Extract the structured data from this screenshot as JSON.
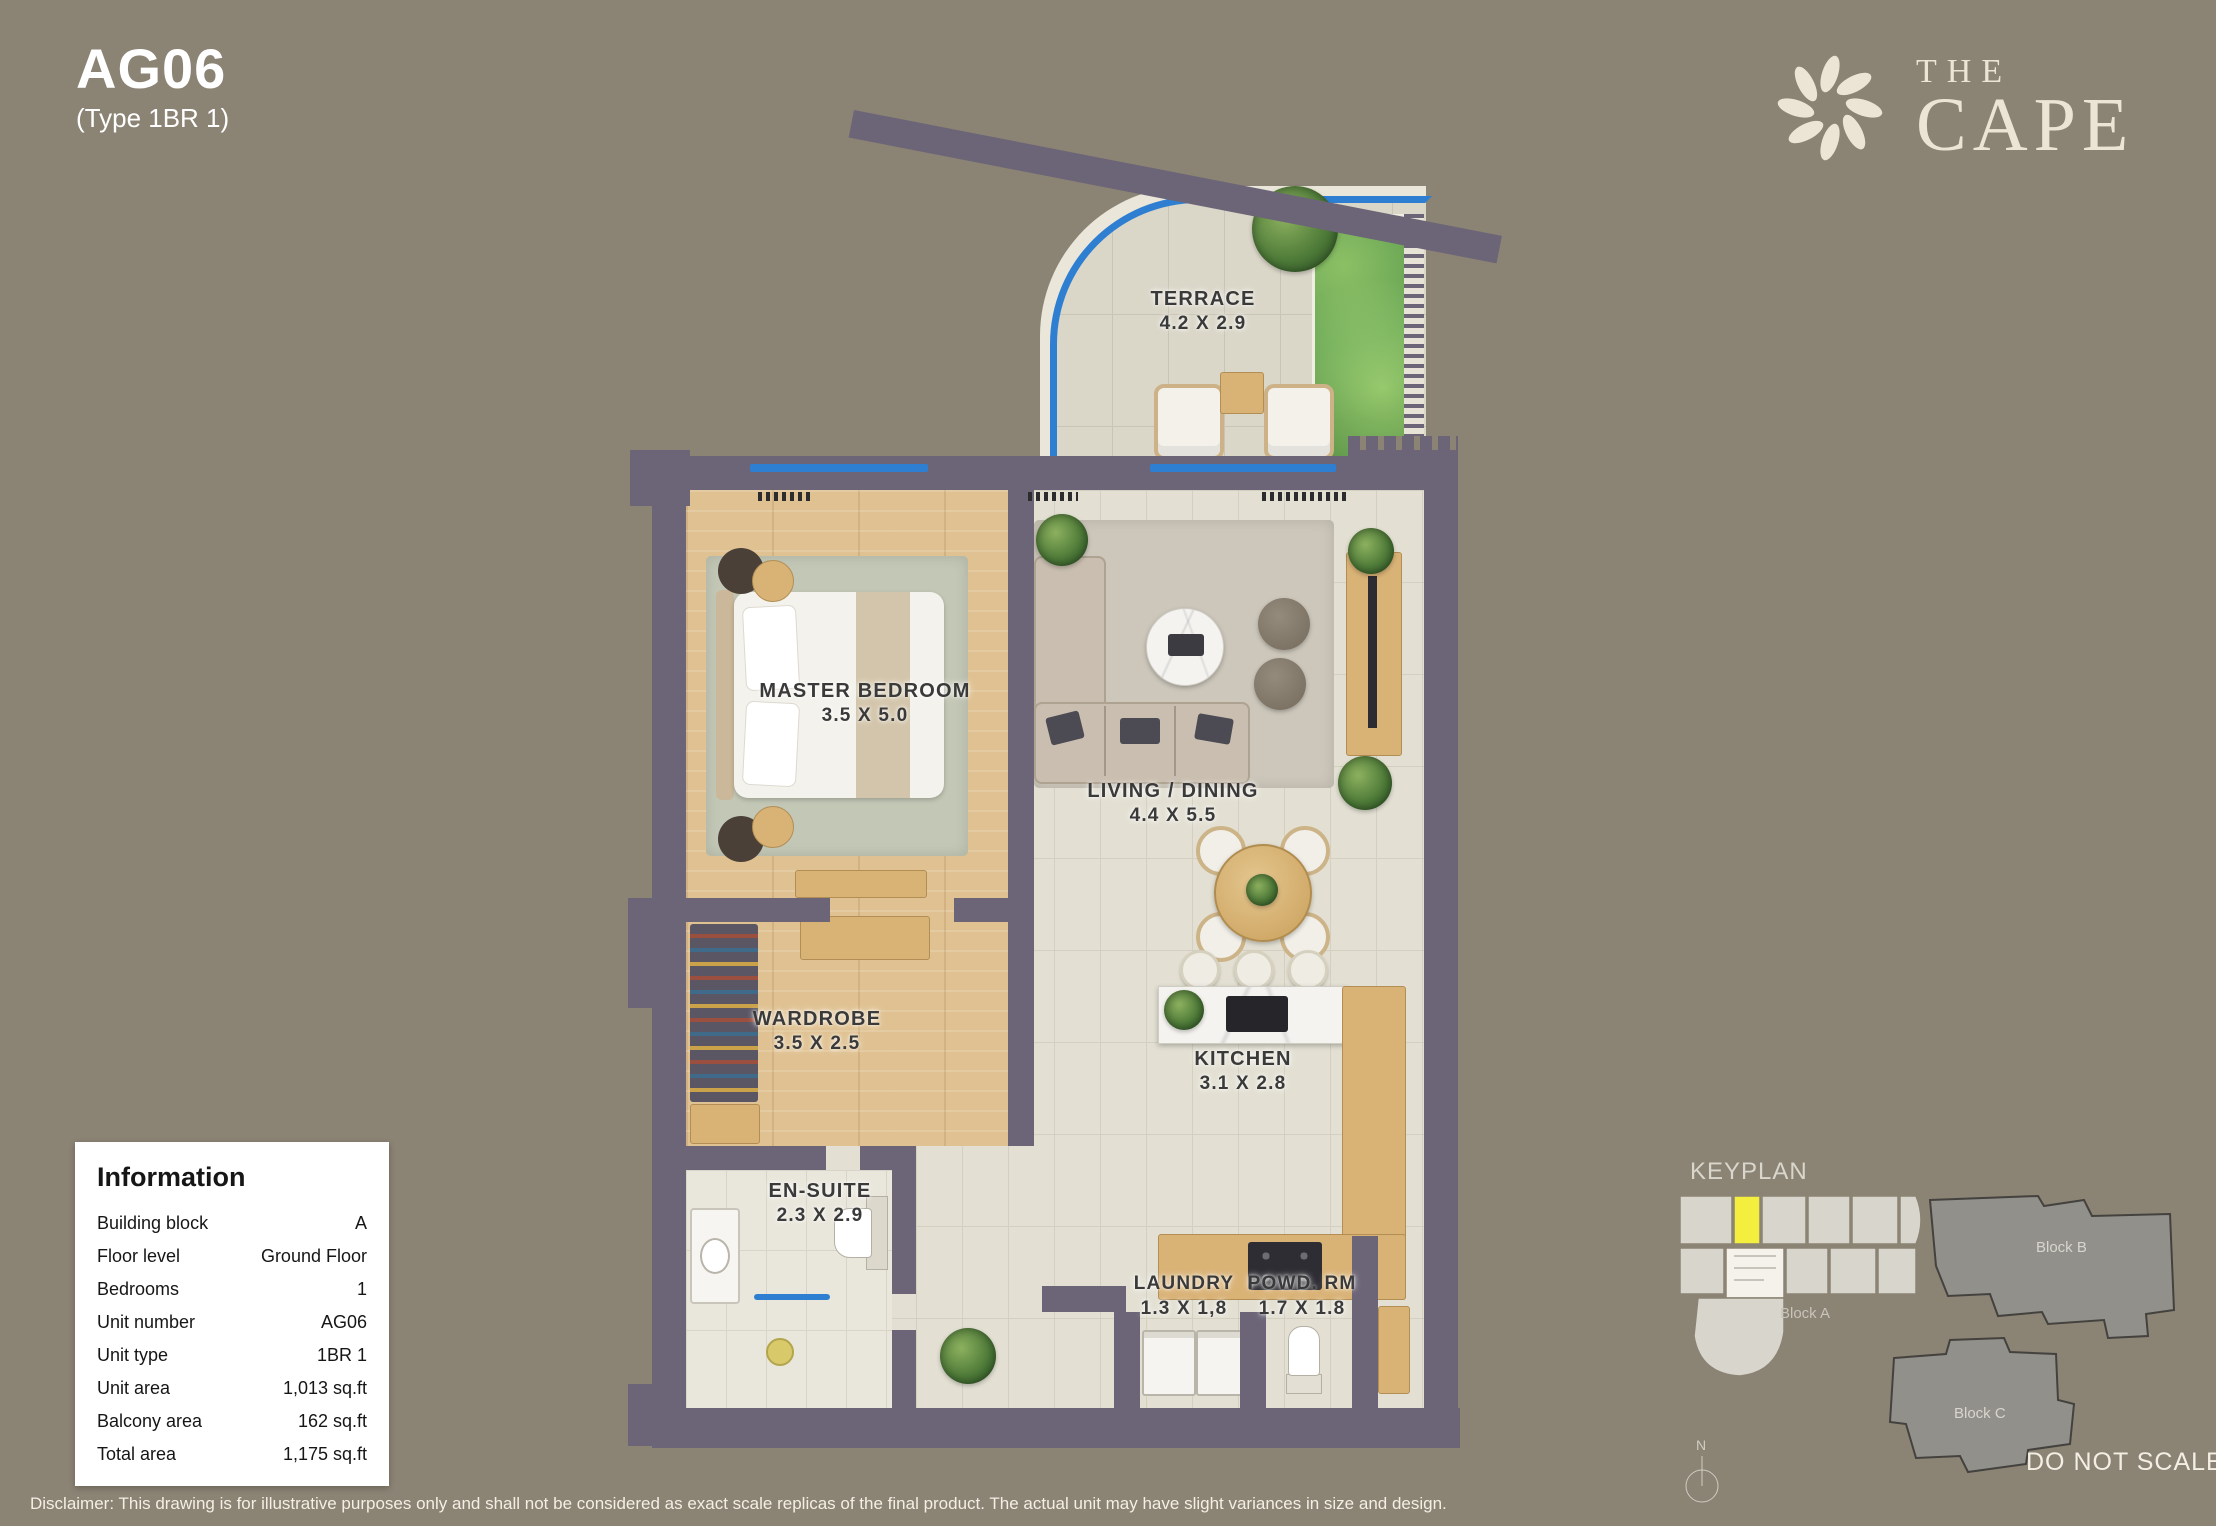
{
  "header": {
    "unit_code": "AG06",
    "unit_type": "(Type 1BR 1)"
  },
  "logo": {
    "line1": "THE",
    "line2": "CAPE",
    "icon": "flower-starburst-icon"
  },
  "rooms": [
    {
      "name": "TERRACE",
      "dims": "4.2 X 2.9"
    },
    {
      "name": "MASTER BEDROOM",
      "dims": "3.5 X 5.0"
    },
    {
      "name": "LIVING / DINING",
      "dims": "4.4 X 5.5"
    },
    {
      "name": "WARDROBE",
      "dims": "3.5 X 2.5"
    },
    {
      "name": "KITCHEN",
      "dims": "3.1 X 2.8"
    },
    {
      "name": "EN-SUITE",
      "dims": "2.3 X 2.9"
    },
    {
      "name": "LAUNDRY",
      "dims": "1.3 X 1,8"
    },
    {
      "name": "POWD. RM",
      "dims": "1.7 X 1.8"
    }
  ],
  "information": {
    "title": "Information",
    "rows": [
      {
        "label": "Building block",
        "value": "A"
      },
      {
        "label": "Floor level",
        "value": "Ground Floor"
      },
      {
        "label": "Bedrooms",
        "value": "1"
      },
      {
        "label": "Unit number",
        "value": "AG06"
      },
      {
        "label": "Unit type",
        "value": "1BR 1"
      },
      {
        "label": "Unit area",
        "value": "1,013 sq.ft"
      },
      {
        "label": "Balcony area",
        "value": "162 sq.ft"
      },
      {
        "label": "Total area",
        "value": "1,175 sq.ft"
      }
    ]
  },
  "keyplan": {
    "title": "KEYPLAN",
    "blocks": [
      {
        "label": "Block A"
      },
      {
        "label": "Block B"
      },
      {
        "label": "Block C"
      }
    ],
    "compass_n": "N",
    "do_not_scale": "DO NOT SCALE"
  },
  "disclaimer": "Disclaimer: This drawing is for illustrative purposes only and shall not be considered as exact scale replicas of the final product. The actual unit may have slight variances in size and design.",
  "colors": {
    "background": "#8b8374",
    "wall": "#6c6577",
    "glazing_blue": "#2e7fd1",
    "highlight_yellow": "#f4ef3e",
    "logo_cream": "#ece5d5",
    "wood_floor": "#e0c292",
    "tile_floor": "#e3e0d3"
  }
}
